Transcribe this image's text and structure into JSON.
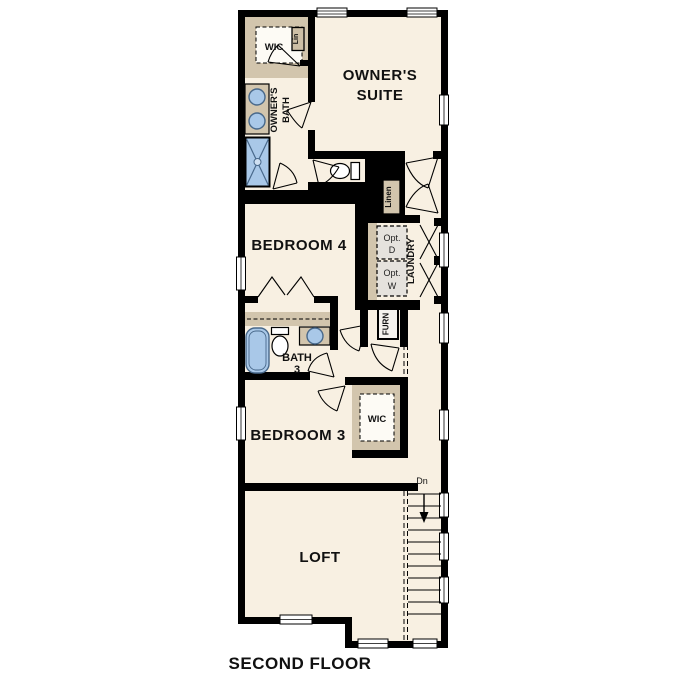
{
  "title": "SECOND FLOOR",
  "colors": {
    "floor": "#f8f0e2",
    "wall": "#000000",
    "closet_tan": "#d2c5ad",
    "fixture_blue": "#a9c8e8",
    "appliance_gray": "#e5e2dd",
    "background": "#ffffff"
  },
  "rooms": {
    "owners_suite": {
      "label_line1": "OWNER'S",
      "label_line2": "SUITE"
    },
    "owners_wic": {
      "label": "WIC",
      "lin_label": "Lin"
    },
    "owners_bath": {
      "label_line1": "OWNER'S",
      "label_line2": "BATH"
    },
    "bedroom4": {
      "label": "BEDROOM 4"
    },
    "hall": {
      "linen_label": "Linen"
    },
    "laundry": {
      "label": "LAUNDRY",
      "opt_dryer_line1": "Opt.",
      "opt_dryer_line2": "D",
      "opt_washer_line1": "Opt.",
      "opt_washer_line2": "W"
    },
    "furnace": {
      "label": "FURN"
    },
    "bath3": {
      "label_line1": "BATH",
      "label_line2": "3"
    },
    "bedroom3": {
      "label": "BEDROOM 3",
      "wic_label": "WIC"
    },
    "loft": {
      "label": "LOFT"
    },
    "stairs": {
      "direction_label": "Dn"
    }
  }
}
